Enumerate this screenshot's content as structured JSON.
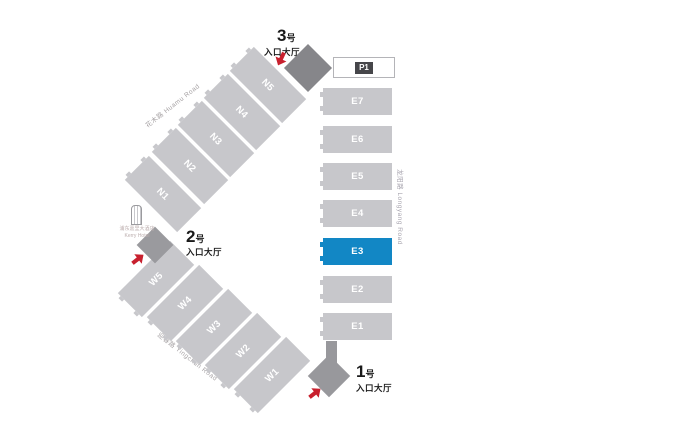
{
  "map": {
    "parking": {
      "label": "P1"
    },
    "e_halls": [
      {
        "id": "E7",
        "highlight": false
      },
      {
        "id": "E6",
        "highlight": false
      },
      {
        "id": "E5",
        "highlight": false
      },
      {
        "id": "E4",
        "highlight": false
      },
      {
        "id": "E3",
        "highlight": true
      },
      {
        "id": "E2",
        "highlight": false
      },
      {
        "id": "E1",
        "highlight": false
      }
    ],
    "n_halls": [
      {
        "id": "N5"
      },
      {
        "id": "N4"
      },
      {
        "id": "N3"
      },
      {
        "id": "N2"
      },
      {
        "id": "N1"
      }
    ],
    "w_halls": [
      {
        "id": "W5"
      },
      {
        "id": "W4"
      },
      {
        "id": "W3"
      },
      {
        "id": "W2"
      },
      {
        "id": "W1"
      }
    ],
    "entrances": [
      {
        "number": "3",
        "unit": "号",
        "hall_label": "入口大厅"
      },
      {
        "number": "2",
        "unit": "号",
        "hall_label": "入口大厅"
      },
      {
        "number": "1",
        "unit": "号",
        "hall_label": "入口大厅"
      }
    ],
    "roads": [
      {
        "name": "花木路  Huamu Road"
      },
      {
        "name": "龙阳路  Longyang Road"
      },
      {
        "name": "迎春路  Yingchun Road"
      }
    ],
    "landmark": {
      "name_cn": "浦东嘉里大酒店",
      "name_en": "Kerry Hotel"
    },
    "colors": {
      "hall_gray": "#c7c7cb",
      "highlight_blue": "#1287c5",
      "entrance_dark_gray": "#86868a",
      "entrance_mid_gray": "#98989c",
      "arrow_red": "#c8202e"
    }
  }
}
